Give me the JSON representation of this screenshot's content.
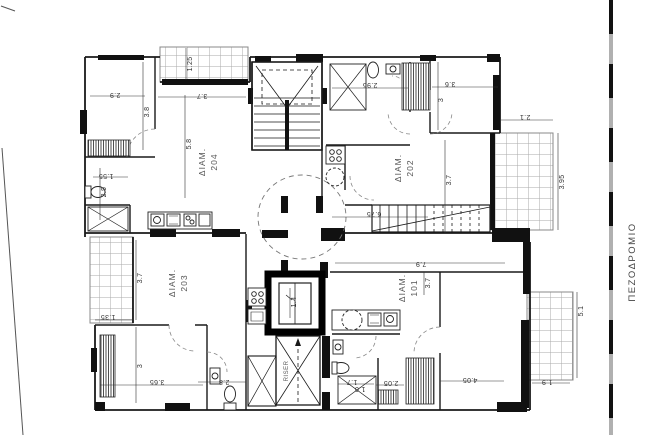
{
  "plan": {
    "apartments": [
      {
        "label": "ΔΙΑΜ.",
        "number": "204"
      },
      {
        "label": "ΔΙΑΜ.",
        "number": "202"
      },
      {
        "label": "ΔΙΑΜ.",
        "number": "203"
      },
      {
        "label": "ΔΙΑΜ.",
        "number": "101"
      }
    ],
    "shaft_label": "RISER",
    "sidewalk_label": "ΠΕΖΟΔΡΟΜΙΟ",
    "dims": {
      "bed204_w": "2.9",
      "bed204_h": "3.8",
      "balc_top": "1.25",
      "terr_top": "3.7",
      "bath202_w": "2.95",
      "bed202tr_w": "3.6",
      "bed202tr_h": "3",
      "balc_right_w": "2.1",
      "balc_right_h": "3.95",
      "apt204_h": "5.8",
      "hall204_w": "1.55",
      "hall204_h": "2.9",
      "apt202_w": "6.75",
      "apt202_h": "3.7",
      "apt101_w": "7.9",
      "apt101_h": "3.7",
      "balc203_h": "3.7",
      "bed203_h": "3",
      "bed203_w": "3.65",
      "balc203_w": "1.35",
      "bath203_w": "2.8",
      "lift_w": "1.4",
      "bath101_w": "1.7",
      "bath101_d": "1.0",
      "ward101_w": "2.05",
      "bed101_w": "4.05",
      "balc101_w": "1.9",
      "balc101_h": "5.1"
    },
    "colors": {
      "wall": "#1a1a1a",
      "tile_line": "#aaaaaa",
      "boundary_gray": "#b0b0b0",
      "dashed": "#777777"
    }
  }
}
